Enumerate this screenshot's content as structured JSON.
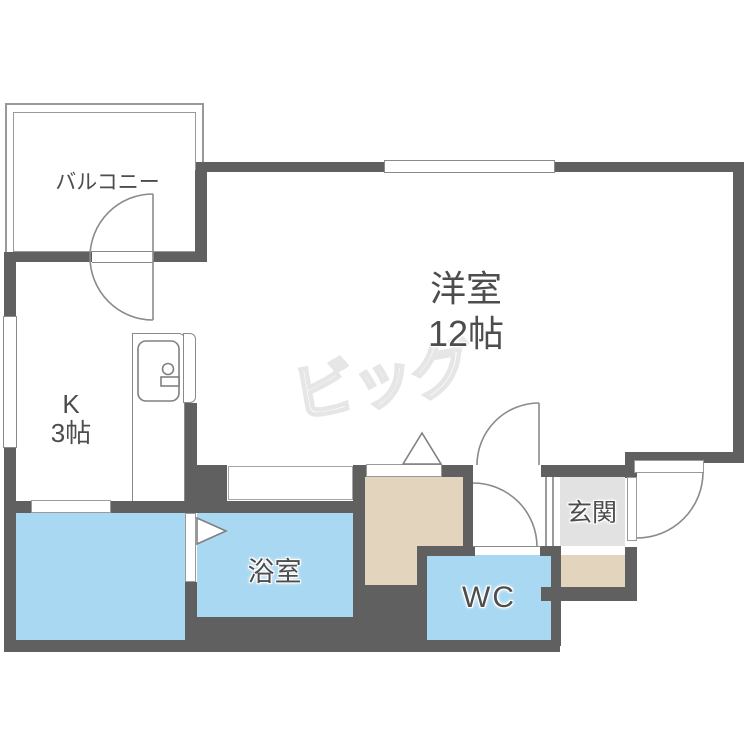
{
  "floorplan": {
    "balcony_label": "バルコニー",
    "main_room_label": "洋室",
    "main_room_size": "12帖",
    "kitchen_label": "K",
    "kitchen_size": "3帖",
    "bathroom_label": "浴室",
    "wc_label": "WC",
    "entrance_label": "玄関",
    "watermark": "ビッグ",
    "colors": {
      "wall": "#606060",
      "water_room": "#a8d8f2",
      "hall": "#e3d4be",
      "entrance_floor": "#e2e2e2",
      "line": "#8a8a8a",
      "label_text": "#4d4d4d",
      "watermark": "#e6e6e6"
    }
  }
}
